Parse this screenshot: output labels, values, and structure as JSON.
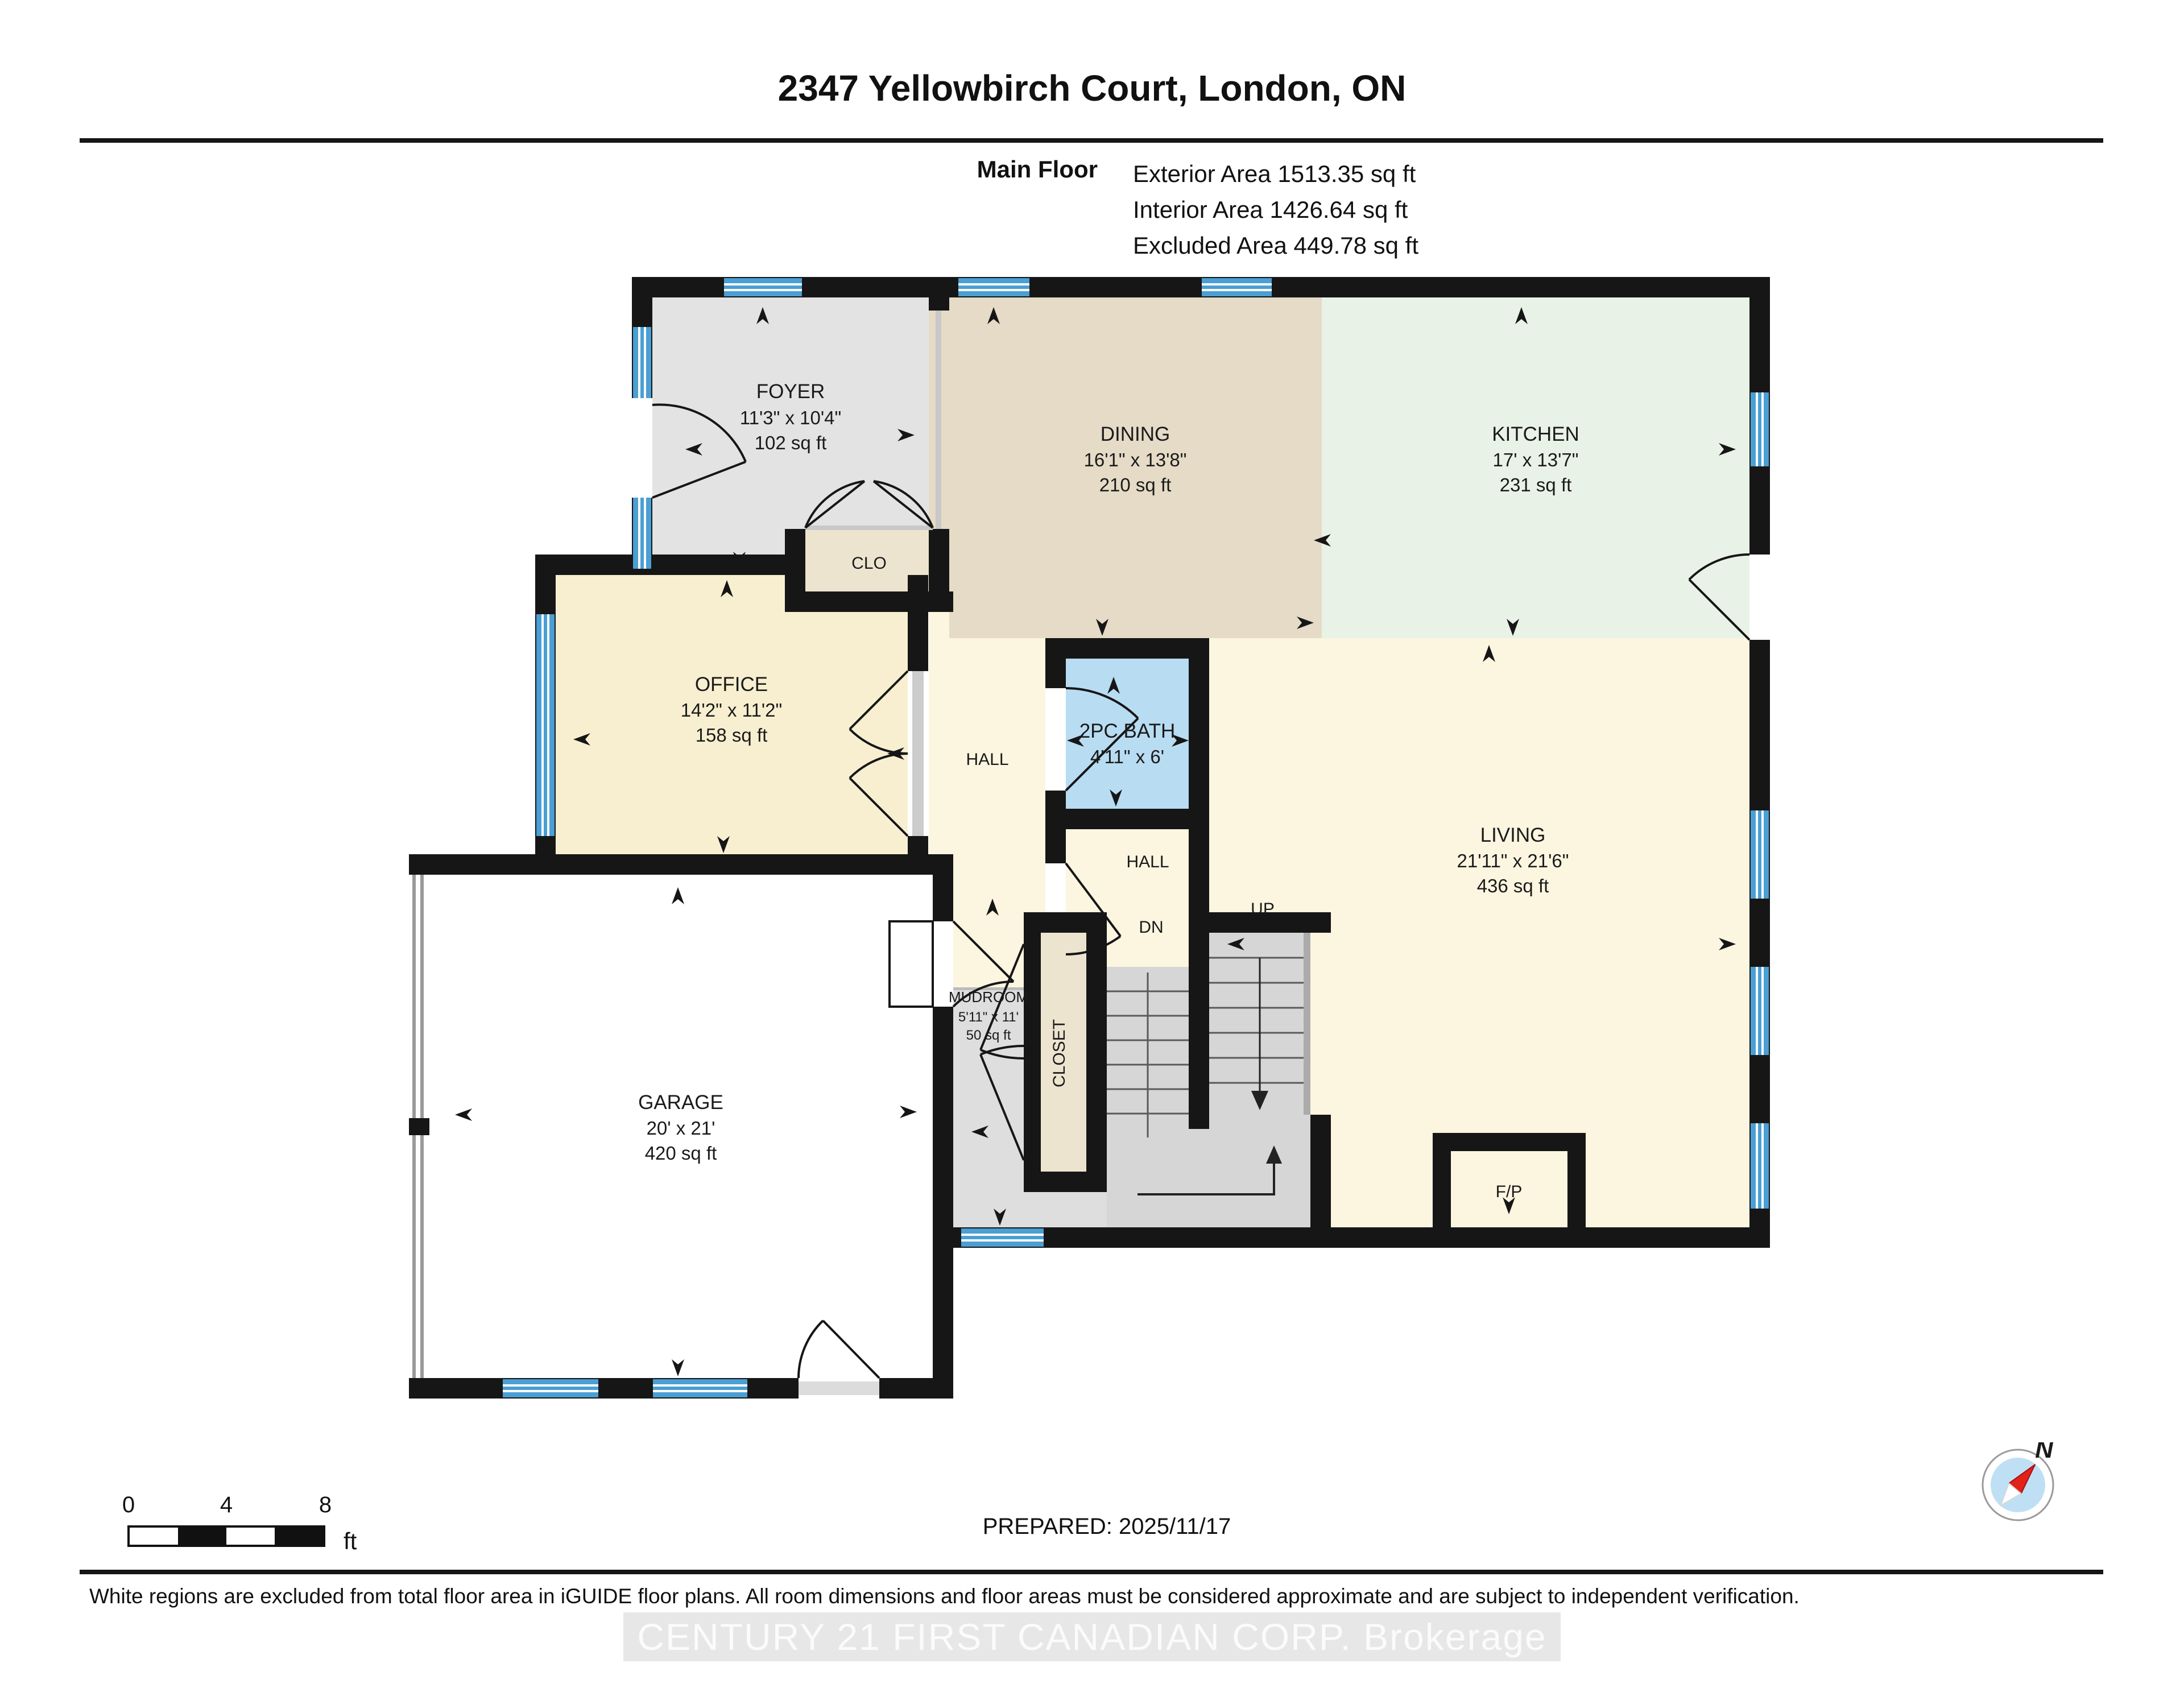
{
  "header": {
    "title": "2347 Yellowbirch Court, London, ON",
    "floor_label": "Main Floor",
    "areas": [
      "Exterior Area 1513.35 sq ft",
      "Interior Area 1426.64 sq ft",
      "Excluded Area 449.78 sq ft"
    ]
  },
  "rooms": [
    {
      "id": "foyer",
      "name": "FOYER",
      "dims": "11'3\" x 10'4\"",
      "area": "102 sq ft"
    },
    {
      "id": "dining",
      "name": "DINING",
      "dims": "16'1\" x 13'8\"",
      "area": "210 sq ft"
    },
    {
      "id": "kitchen",
      "name": "KITCHEN",
      "dims": "17' x 13'7\"",
      "area": "231 sq ft"
    },
    {
      "id": "office",
      "name": "OFFICE",
      "dims": "14'2\" x 11'2\"",
      "area": "158 sq ft"
    },
    {
      "id": "bath",
      "name": "2PC BATH",
      "dims": "4'11\" x 6'"
    },
    {
      "id": "living",
      "name": "LIVING",
      "dims": "21'11\" x 21'6\"",
      "area": "436 sq ft"
    },
    {
      "id": "mudroom",
      "name": "MUDROOM",
      "dims": "5'11\" x 11'",
      "area": "50 sq ft"
    },
    {
      "id": "garage",
      "name": "GARAGE",
      "dims": "20' x 21'",
      "area": "420 sq ft"
    }
  ],
  "labels": {
    "clo": "CLO",
    "hall_upper": "HALL",
    "hall_lower": "HALL",
    "dn": "DN",
    "up": "UP",
    "closet": "CLOSET",
    "fireplace": "F/P"
  },
  "scale_bar": {
    "ticks": [
      "0",
      "4",
      "8"
    ],
    "unit": "ft"
  },
  "compass": {
    "north_label": "N"
  },
  "footer": {
    "prepared": "PREPARED: 2025/11/17",
    "disclaimer": "White regions are excluded from total floor area in iGUIDE floor plans. All room dimensions and floor areas must be considered approximate and are subject to independent verification.",
    "watermark": "CENTURY 21 FIRST CANADIAN CORP. Brokerage"
  },
  "colors": {
    "wall": "#161616",
    "window": "#4a9fd4",
    "foyer_floor": "#e3e3e3",
    "dining_floor": "#e5dbc6",
    "kitchen_floor": "#e9f2e6",
    "office_floor": "#f8efd0",
    "living_floor": "#fcf5e0",
    "bath_floor": "#b8dcf2",
    "closet_floor": "#ede4d0",
    "mudroom_floor": "#dedede",
    "stairs": "#d6d6d6",
    "garage_floor": "#ffffff",
    "compass_needle": "#e32119"
  }
}
